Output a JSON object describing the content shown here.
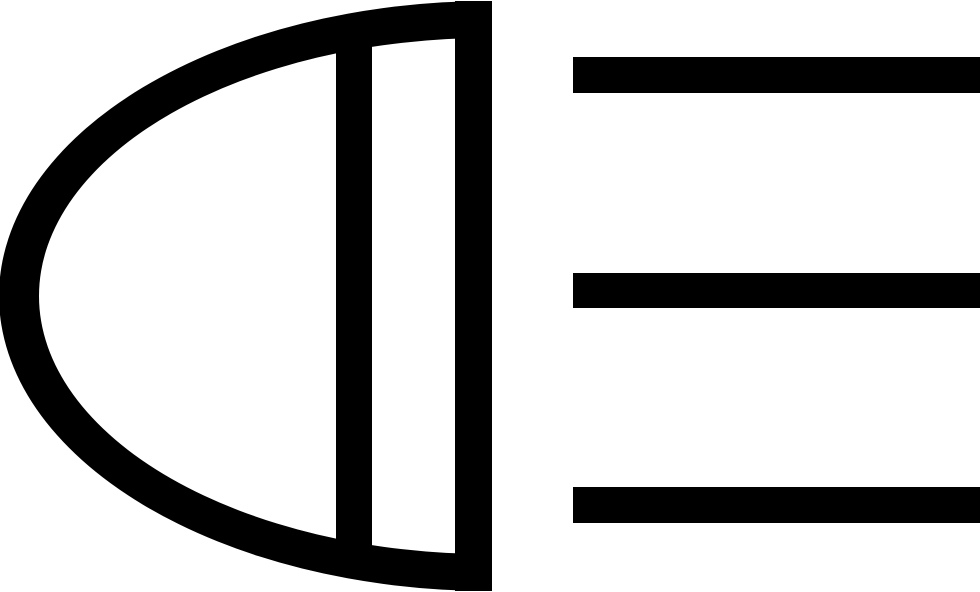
{
  "icon": {
    "name": "headlight-with-beams-icon",
    "description": "Black glyph of a car lamp: half-ellipse housing with flat right edge, inner lens divider bar, and three horizontal light beam lines pointing right",
    "color": "#000000",
    "background_color": "#ffffff",
    "beam_count": "3"
  }
}
